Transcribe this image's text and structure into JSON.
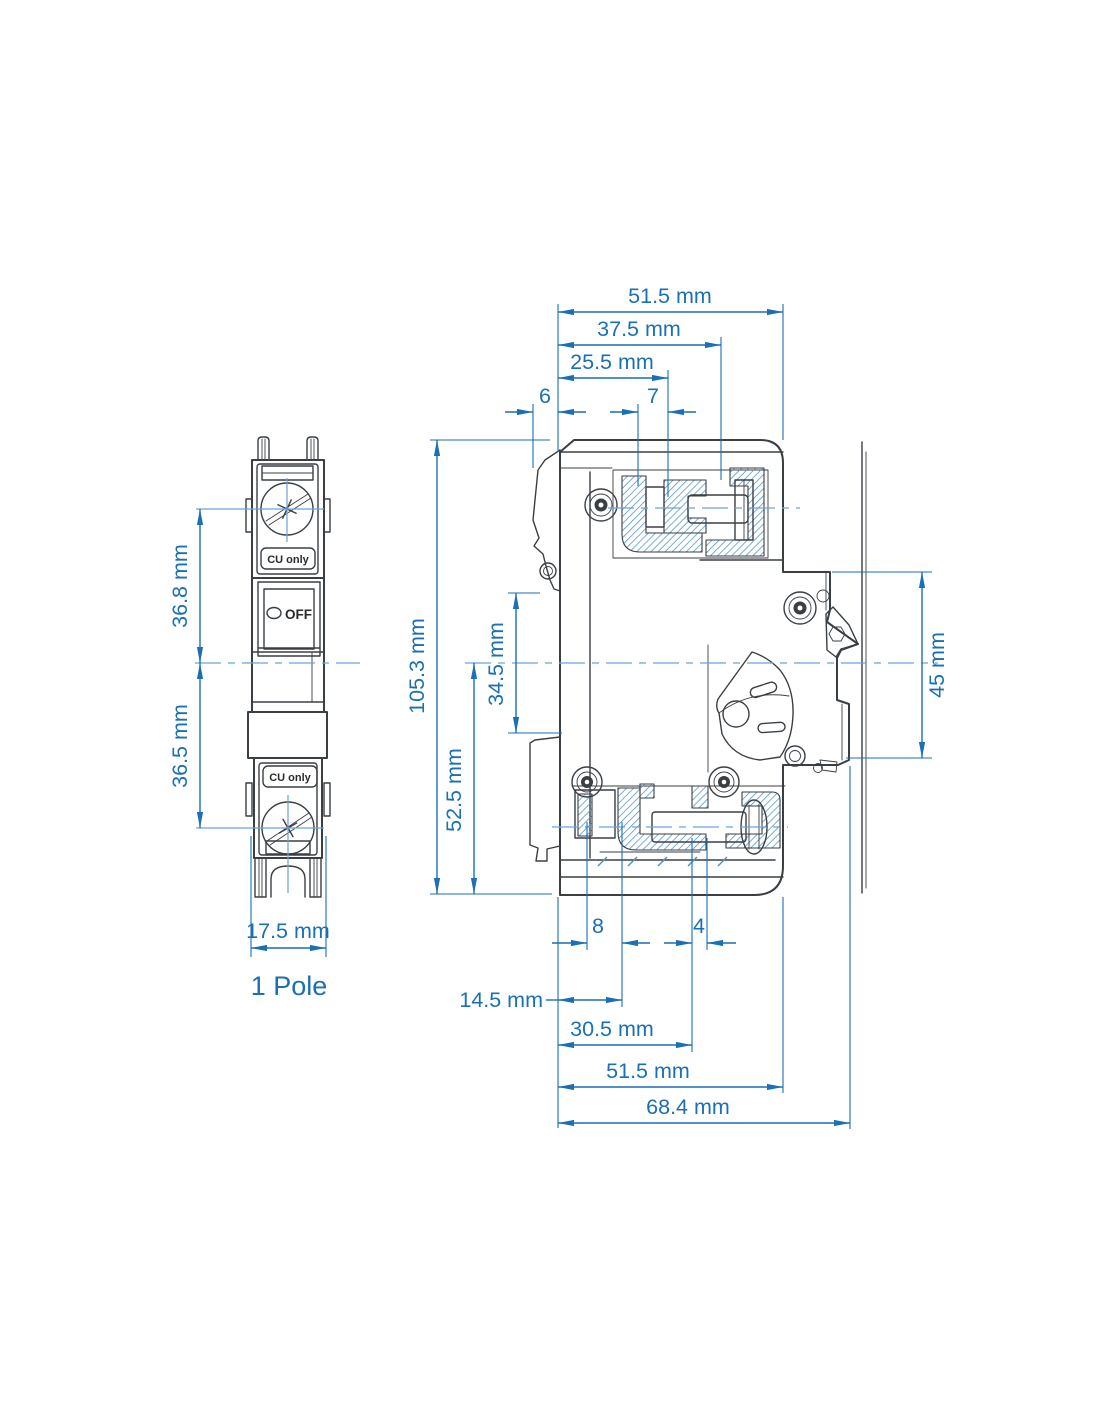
{
  "page": {
    "background": "#FFFFFF"
  },
  "colors": {
    "dimension_blue": "#1A6FB5",
    "centerline_blue": "#69A4DC",
    "hatch_blue": "#4E91C8",
    "line_dark": "#3A3F44"
  },
  "front_view": {
    "label": "1 Pole",
    "cu_only_label": "CU only",
    "off_label": "OFF",
    "dims": {
      "upper_height": "36.8 mm",
      "lower_height": "36.5 mm",
      "width": "17.5 mm"
    }
  },
  "side_view": {
    "dims": {
      "top_overall": "51.5 mm",
      "top_37_5": "37.5 mm",
      "top_25_5": "25.5 mm",
      "top_6": "6",
      "top_7": "7",
      "left_total_height": "105.3 mm",
      "left_52_5": "52.5 mm",
      "left_34_5": "34.5 mm",
      "right_45": "45 mm",
      "bottom_8": "8",
      "bottom_4": "4",
      "bottom_14_5": "14.5 mm",
      "bottom_30_5": "30.5 mm",
      "bottom_51_5": "51.5 mm",
      "bottom_68_4": "68.4 mm"
    }
  }
}
